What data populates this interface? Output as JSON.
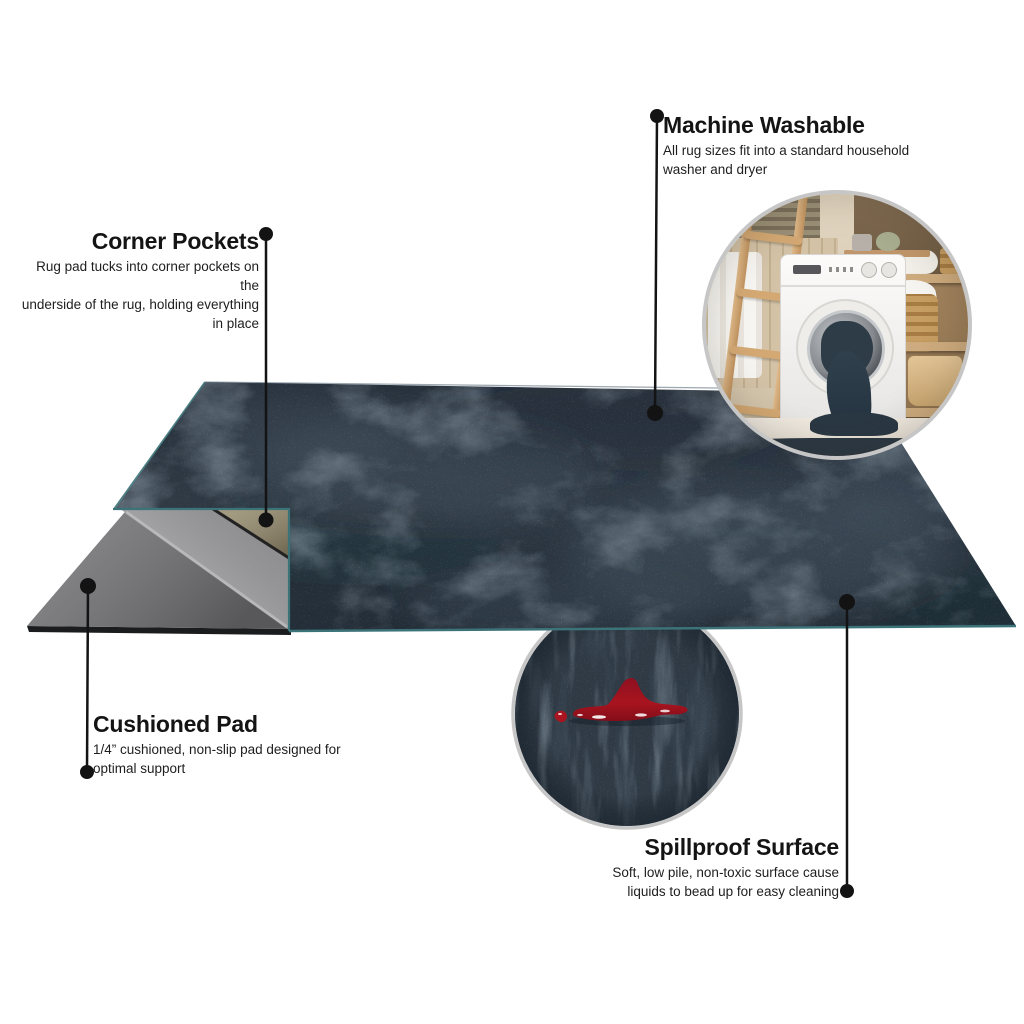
{
  "callouts": {
    "machine_washable": {
      "title": "Machine Washable",
      "body": [
        "All rug sizes fit into a standard household",
        "washer and dryer"
      ]
    },
    "corner_pockets": {
      "title": "Corner Pockets",
      "body": [
        "Rug pad tucks into corner pockets on the",
        "underside of the rug, holding everything",
        "in place"
      ]
    },
    "cushioned_pad": {
      "title": "Cushioned Pad",
      "body": [
        "1/4” cushioned, non-slip pad designed for",
        "optimal support"
      ]
    },
    "spillproof_surface": {
      "title": "Spillproof Surface",
      "body": [
        "Soft, low pile, non-toxic surface cause",
        "liquids to bead up for easy cleaning"
      ]
    }
  },
  "colors": {
    "rug_navy": "#2f3a45",
    "rug_navy_dark": "#27313c",
    "rug_sheen": "#7d93a3",
    "binding_teal": "#3c7379",
    "pad_gray": "#747477",
    "underside_gray": "#a4a4a7",
    "pocket_tan": "#93896c",
    "spill_red": "#a8141f",
    "callout_ink": "#131313",
    "inset_ring": "#c6c6c6"
  }
}
